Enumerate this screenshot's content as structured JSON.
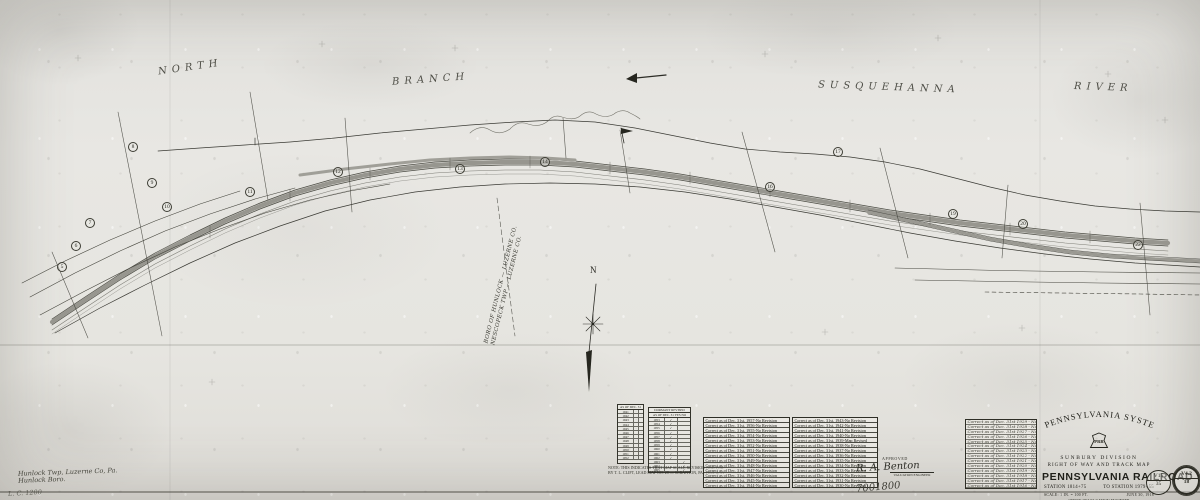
{
  "geo_labels": {
    "north": "NORTH",
    "branch": "BRANCH",
    "susquehanna": "SUSQUEHANNA",
    "river": "RIVER"
  },
  "north_arrow_letter": "N",
  "boundary_label": {
    "line1": "BORO OF HUNLOCK — LUZERNE CO.",
    "line2": "NESCOPECK TWP — LUZERNE CO."
  },
  "corner_notes": {
    "line1": "Hunlock Twp, Luzerne Co, Pa.",
    "line2": "Hunlock Boro.",
    "ref": "L. C. 1200"
  },
  "markers": [
    {
      "n": "5",
      "x": 57,
      "y": 262
    },
    {
      "n": "6",
      "x": 71,
      "y": 241
    },
    {
      "n": "7",
      "x": 85,
      "y": 218
    },
    {
      "n": "8",
      "x": 128,
      "y": 142
    },
    {
      "n": "9",
      "x": 147,
      "y": 178
    },
    {
      "n": "10",
      "x": 162,
      "y": 202
    },
    {
      "n": "11",
      "x": 245,
      "y": 187
    },
    {
      "n": "12",
      "x": 333,
      "y": 167
    },
    {
      "n": "13",
      "x": 455,
      "y": 164
    },
    {
      "n": "14",
      "x": 540,
      "y": 157
    },
    {
      "n": "16",
      "x": 765,
      "y": 182
    },
    {
      "n": "17",
      "x": 833,
      "y": 147
    },
    {
      "n": "19",
      "x": 948,
      "y": 209
    },
    {
      "n": "20",
      "x": 1018,
      "y": 219
    },
    {
      "n": "22",
      "x": 1133,
      "y": 240
    }
  ],
  "index_table": {
    "header1": "AS OF",
    "header2": "DEC. 31",
    "rows": [
      {
        "y": "1941",
        "m1": "·",
        "m2": ""
      },
      {
        "y": "1942",
        "m1": "",
        "m2": "·"
      },
      {
        "y": "1943",
        "m1": "·",
        "m2": ""
      },
      {
        "y": "1944",
        "m1": "",
        "m2": ""
      },
      {
        "y": "1945",
        "m1": "·",
        "m2": ""
      },
      {
        "y": "1946",
        "m1": "",
        "m2": "·"
      },
      {
        "y": "1947",
        "m1": "",
        "m2": ""
      },
      {
        "y": "1948",
        "m1": "·",
        "m2": ""
      },
      {
        "y": "1949",
        "m1": "",
        "m2": ""
      },
      {
        "y": "1950",
        "m1": "·",
        "m2": "·"
      },
      {
        "y": "1951",
        "m1": "",
        "m2": ""
      },
      {
        "y": "1952",
        "m1": "·",
        "m2": ""
      }
    ]
  },
  "dormant_table": {
    "header1": "DORMANT",
    "header2": "REVISED",
    "sub": "AS OF DEC. 31",
    "yes": "YES",
    "no": "NO",
    "rows": [
      {
        "y": "1953",
        "d": "✓",
        "r": ""
      },
      {
        "y": "1954",
        "d": "✓",
        "r": ""
      },
      {
        "y": "1955",
        "d": "✓",
        "r": ""
      },
      {
        "y": "1956",
        "d": "✓",
        "r": ""
      },
      {
        "y": "1957",
        "d": "✓",
        "r": ""
      },
      {
        "y": "1958",
        "d": "✓",
        "r": ""
      },
      {
        "y": "1959",
        "d": "✓",
        "r": ""
      },
      {
        "y": "1960",
        "d": "✓",
        "r": ""
      },
      {
        "y": "1961",
        "d": "✓",
        "r": ""
      },
      {
        "y": "1962",
        "d": "✓",
        "r": ""
      },
      {
        "y": "1963",
        "d": "",
        "r": "✓"
      },
      {
        "y": "1964",
        "d": "",
        "r": "✓"
      },
      {
        "y": "1965",
        "d": "",
        "r": "✓"
      }
    ]
  },
  "note_lines": {
    "line1": "NOTE: THIS INDICATES THAT MAP SCALE REVISION AND FOR",
    "line2": "BY T. L. CLIFT, LEAD MAP NO. 28 — SCRANTON, PA., JULY 2, 51"
  },
  "revision_table_1": {
    "rows": [
      "Correct as of Dec. 31st, 1957-No Revision",
      "Correct as of Dec. 31st, 1956-No Revision",
      "Correct as of Dec. 31st, 1955-No Revision",
      "Correct as of Dec. 31st, 1954-No Revision",
      "Correct as of Dec. 31st, 1953-No Revision",
      "Correct as of Dec. 31st, 1952-No Revision",
      "Correct as of Dec. 31st, 1951-No Revision",
      "Correct as of Dec. 31st, 1950-No Revision",
      "Correct as of Dec. 31st, 1949-No Revision",
      "Correct as of Dec. 31st, 1948-No Revision",
      "Correct as of Dec. 31st, 1947-No Revision",
      "Correct as of Dec. 31st, 1946-No Revision",
      "Correct as of Dec. 31st, 1945-No Revision",
      "Correct as of Dec. 31st, 1944-No Revision"
    ]
  },
  "revision_table_2": {
    "rows": [
      "Correct as of Dec. 31st, 1943-No Revision",
      "Correct as of Dec. 31st, 1942-No Revision",
      "Correct as of Dec. 31st, 1941-No Revision",
      "Correct as of Dec. 31st, 1940-No Revision",
      "Correct as of Dec. 31st, 1939-Map Revised",
      "Correct as of Dec. 31st, 1938-No Revision",
      "Correct as of Dec. 31st, 1937-No Revision",
      "Correct as of Dec. 31st, 1936-No Revision",
      "Correct as of Dec. 31st, 1935-No Revision",
      "Correct as of Dec. 31st, 1934-No Revision",
      "Correct as of Dec. 31st, 1933-No Revision",
      "Correct as of Dec. 31st, 1932-No Revision",
      "Correct as of Dec. 31st, 1931-No Revision",
      "Correct as of Dec. 31st, 1930-No Revision"
    ]
  },
  "revision_table_3": {
    "rows": [
      "Correct as of Dec. 31st 1929 - No Revision",
      "Correct as of Dec. 31st 1928 - No Revision",
      "Correct as of Dec. 31st 1927 - No Revision",
      "Correct as of Dec. 31st 1926 - No Revision",
      "Correct as of Dec. 31st 1925 - No Revision",
      "Correct as of Dec. 31st 1924 - No Revision",
      "Correct as of Dec. 31st 1923 - No Revision",
      "Correct as of Dec. 31st 1922 - No Revision",
      "Correct as of Dec. 31st 1921 - No Revision",
      "Correct as of Dec. 31st 1920 - No Revision",
      "Correct as of Dec. 31st 1919 - No Revision",
      "Correct as of Dec. 31st 1918 - No Revision",
      "Correct as of Dec. 31st 1917 - No Revision",
      "Correct as of Dec. 31st 1916 - No Revision"
    ]
  },
  "signature": {
    "approved": "APPROVED",
    "name": "R. A. Benton",
    "caption": "VALUATION ENGINEER",
    "number": "7001800"
  },
  "title_block": {
    "system": "PENNSYLVANIA  SYSTEM",
    "logo": "PRR",
    "division": "SUNBURY DIVISION",
    "map_type": "RIGHT OF WAY AND TRACK MAP",
    "railroad": "PENNSYLVANIA  RAILROAD",
    "station_from": "STATION 1814+75",
    "station_to": "TO STATION 1979+55",
    "scale": "SCALE: 1 IN. = 100 FT.",
    "date": "JUNE 30, 1918",
    "office1": "OFFICE OF VALUATION ENGINEER",
    "office2": "PHILADELPHIA, PA.",
    "stamp1_top": "V15",
    "stamp1_bottom": "35",
    "stamp2_top": "V4.2",
    "stamp2_bottom": "18"
  },
  "ink_color": "#3a3a34",
  "track_gray": "#97968f",
  "paper_color": "#e6e5e1"
}
